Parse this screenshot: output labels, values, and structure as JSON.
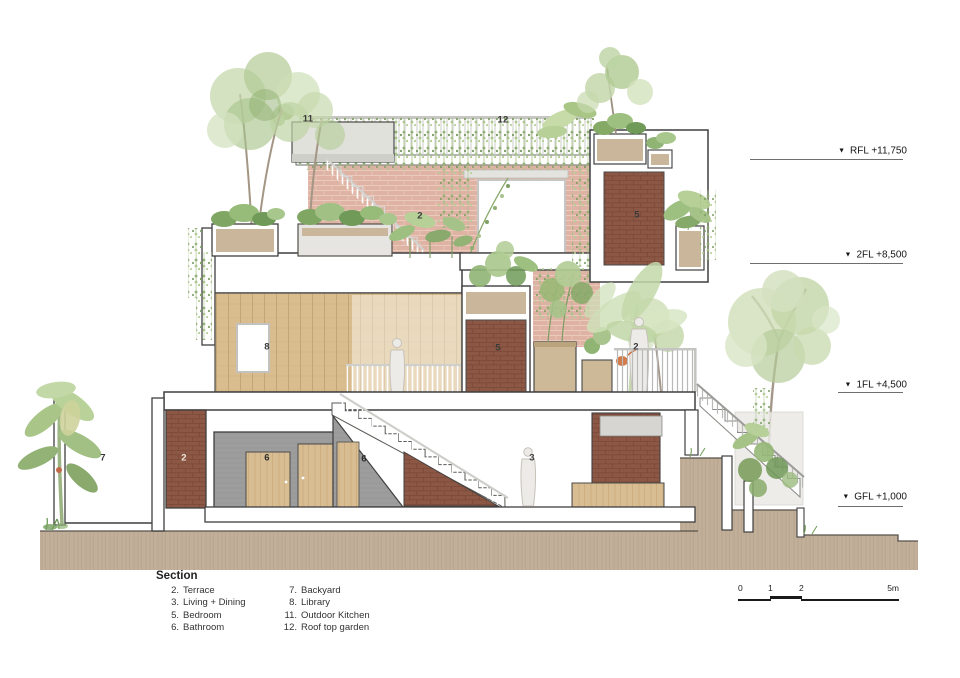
{
  "drawing": {
    "title": "Section",
    "type": "architectural-section"
  },
  "levels": {
    "marker_icon": "▼",
    "items": [
      {
        "id": "rfl",
        "label": "RFL +11,750"
      },
      {
        "id": "2fl",
        "label": "2FL +8,500"
      },
      {
        "id": "1fl",
        "label": "1FL +4,500"
      },
      {
        "id": "gfl",
        "label": "GFL +1,000"
      }
    ]
  },
  "plan_labels": {
    "roof_kitchen": "11",
    "roof_garden": "12",
    "terrace_2fl": "2",
    "bedroom_2fl": "5",
    "library": "8",
    "bedroom_1fl": "5",
    "terrace_1fl": "2",
    "backyard": "7",
    "terrace_gf": "2",
    "bathroom": "6",
    "bathroom_understair": "6",
    "living_dining": "3"
  },
  "legend": {
    "title": "Section",
    "col1": [
      {
        "num": "2.",
        "name": "Terrace"
      },
      {
        "num": "3.",
        "name": "Living + Dining"
      },
      {
        "num": "5.",
        "name": "Bedroom"
      },
      {
        "num": "6.",
        "name": "Bathroom"
      }
    ],
    "col2": [
      {
        "num": "7.",
        "name": "Backyard"
      },
      {
        "num": "8.",
        "name": "Library"
      },
      {
        "num": "11.",
        "name": "Outdoor Kitchen"
      },
      {
        "num": "12.",
        "name": "Roof top garden"
      }
    ]
  },
  "scale_bar": {
    "ticks": [
      "0",
      "1",
      "2",
      "5m"
    ]
  },
  "colors": {
    "brick_facade": "#deb3a4",
    "brick_dark": "#8c5845",
    "wood": "#d9bd8e",
    "gray_wall": "#9d9d9d",
    "ground": "#c1af99",
    "foliage": "#8fb474",
    "accent_orange": "#cf6f3a",
    "outline": "#3f3f3f"
  }
}
